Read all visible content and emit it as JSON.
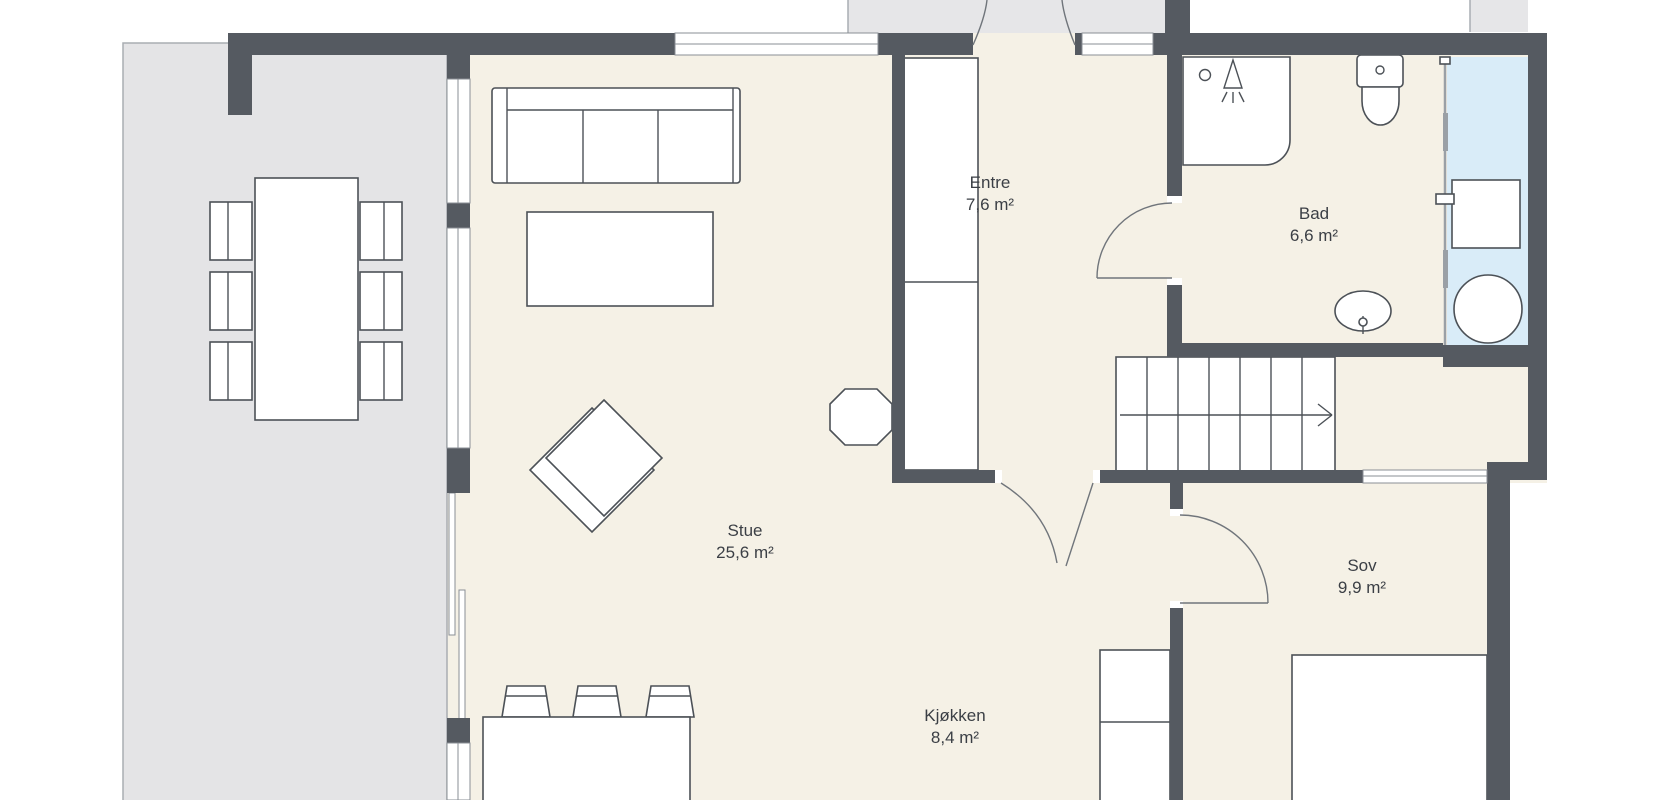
{
  "plan_title": "Floor plan – first floor",
  "rooms": [
    {
      "id": "stue",
      "name": "Stue",
      "area": "25,6 m²"
    },
    {
      "id": "kjokken",
      "name": "Kjøkken",
      "area": "8,4 m²"
    },
    {
      "id": "entre",
      "name": "Entre",
      "area": "7,6 m²"
    },
    {
      "id": "bad",
      "name": "Bad",
      "area": "6,6 m²"
    },
    {
      "id": "sov",
      "name": "Sov",
      "area": "9,9 m²"
    }
  ],
  "furniture": [
    "dining-table",
    "dining-chairs-x6",
    "sofa",
    "coffee-table",
    "armchair",
    "wood-stove",
    "kitchen-island",
    "bar-stools-x3",
    "kitchen-counter",
    "closet",
    "bed",
    "stairs",
    "shower",
    "toilet",
    "sink",
    "washing-machine"
  ],
  "colors": {
    "wall": "#555a61",
    "floor": "#f5f1e6",
    "terrace": "#e4e4e6",
    "porch": "#e6e6e8",
    "wet": "#d9ecf8",
    "line": "#4c5157",
    "winline": "#8a8f95",
    "door": "#70757b",
    "text": "#3b3f45"
  }
}
